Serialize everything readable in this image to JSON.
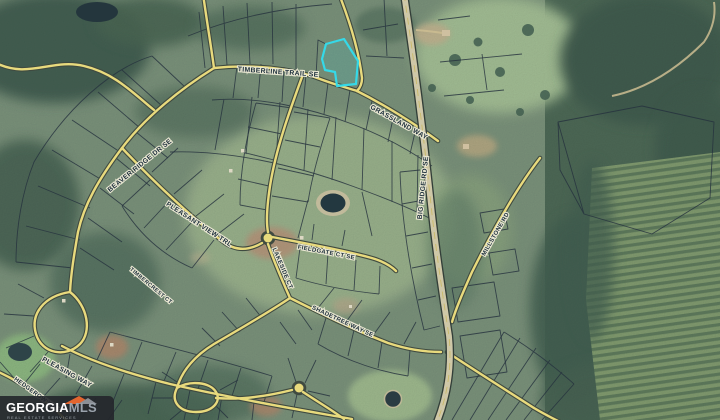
{
  "app": {
    "type": "satellite-parcel-map",
    "description": "Aerial parcel map with subdivision roads and a highlighted lot"
  },
  "watermark": {
    "brand": "GEORGIA",
    "brand_suffix": "MLS",
    "tagline": "REAL ESTATE SERVICES",
    "accent_color": "#e2652f"
  },
  "map": {
    "highlighted_parcel": {
      "outline_color": "#35d9e8",
      "fill_color": "rgba(53,217,232,0.14)"
    },
    "road_labels": {
      "timberline": "TIMBERLINE TRAIL SE",
      "grassland": "GRASSLAND WAY",
      "highway": "BIG RIDGE RD SE",
      "beaver": "BEAVER RIDGE DR SE",
      "pleasant": "PLEASANT VIEW TRL",
      "lakeside": "LAKESIDE CT",
      "fieldgate": "FIELDGATE CT SE",
      "shadetree": "SHADETREE WAY SE",
      "pleasing": "PLEASING WAY",
      "hedgerow": "HEDGEROW WAY",
      "millstone": "MILLSTONE RD",
      "timbercrest": "TIMBERCREST CT"
    },
    "colors": {
      "road_fill": "#e8da7d",
      "highway_fill": "#cfc8a8",
      "parcel_line": "#26323e",
      "water": "#233840",
      "forest_dark": "#3f5c4e",
      "field_light": "#a5c293"
    }
  }
}
